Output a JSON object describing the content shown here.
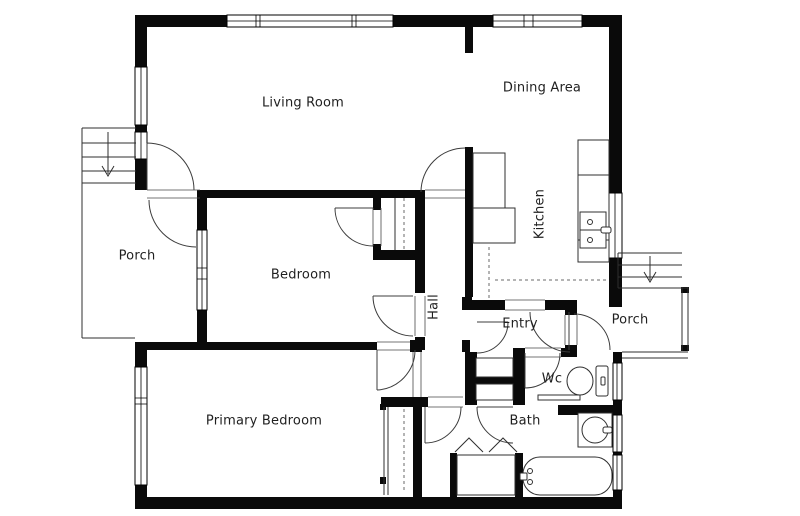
{
  "page": {
    "title": "Floor Plan"
  },
  "rooms": {
    "living_room": {
      "label": "Living Room"
    },
    "dining_area": {
      "label": "Dining Area"
    },
    "kitchen": {
      "label": "Kitchen"
    },
    "porch_left": {
      "label": "Porch"
    },
    "bedroom": {
      "label": "Bedroom"
    },
    "hall": {
      "label": "Hall"
    },
    "entry": {
      "label": "Entry"
    },
    "porch_right": {
      "label": "Porch"
    },
    "wc": {
      "label": "Wc"
    },
    "bath": {
      "label": "Bath"
    },
    "primary_bedroom": {
      "label": "Primary Bedroom"
    }
  },
  "fixtures": [
    "toilet",
    "bathroom-round-sink",
    "bathtub",
    "wc-basin",
    "kitchen-sink",
    "kitchen-counter",
    "refrigerator",
    "bedroom-closet-rod",
    "primary-closet-rod",
    "bifold-closet-doors",
    "stairs-down-arrow-left-porch",
    "stairs-down-arrow-right-porch",
    "porch-railing"
  ],
  "colors": {
    "wall": "#0a0a0a",
    "line": "#2f2f2f",
    "door_arc": "#3c3c3c",
    "background": "#ffffff",
    "text": "#1f1f1f"
  }
}
